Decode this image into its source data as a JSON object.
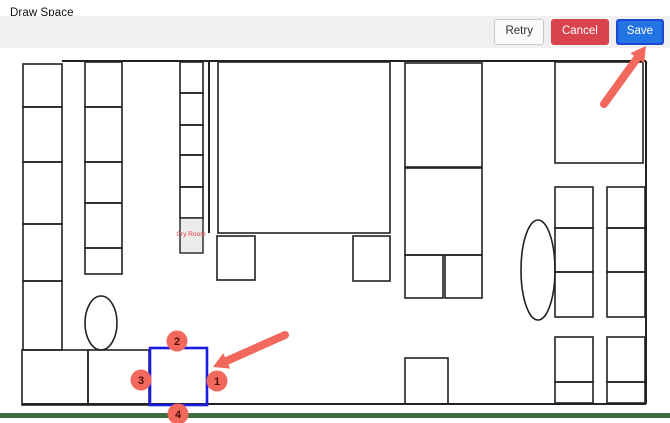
{
  "header": {
    "title": "Draw Space"
  },
  "toolbar": {
    "retry_label": "Retry",
    "cancel_label": "Cancel",
    "save_label": "Save",
    "cancel_color": "#d9434e",
    "save_color": "#2273e3"
  },
  "floorplan": {
    "wall_color": "#222222",
    "annotation_color": "#f2685c",
    "highlight_color": "#1c1ce0",
    "marker_text_color": "#4d120d",
    "green_bar_color": "#3a6e3e",
    "gray_fill": "#ececec",
    "cry_room_label": "Cry Room",
    "cry_room_label_color": "#e23b3b",
    "cry_room_pos": [
      191,
      236
    ],
    "walls": [
      [
        62,
        61,
        646,
        61
      ],
      [
        646,
        61,
        646,
        404
      ],
      [
        22,
        404,
        646,
        404
      ],
      [
        209,
        62,
        209,
        233
      ]
    ],
    "rects": [
      [
        23,
        64,
        39,
        43
      ],
      [
        23,
        107,
        39,
        55
      ],
      [
        23,
        162,
        39,
        62
      ],
      [
        23,
        224,
        39,
        57
      ],
      [
        23,
        281,
        39,
        69
      ],
      [
        22,
        350,
        66,
        55
      ],
      [
        88,
        350,
        61,
        55
      ],
      [
        85,
        62,
        37,
        45
      ],
      [
        85,
        107,
        37,
        55
      ],
      [
        85,
        162,
        37,
        41
      ],
      [
        85,
        203,
        37,
        45
      ],
      [
        85,
        248,
        37,
        26
      ],
      [
        180,
        62,
        23,
        31
      ],
      [
        180,
        93,
        23,
        32
      ],
      [
        180,
        125,
        23,
        30
      ],
      [
        180,
        155,
        23,
        32
      ],
      [
        180,
        187,
        23,
        31
      ],
      [
        218,
        62,
        172,
        171
      ],
      [
        217,
        236,
        38,
        44
      ],
      [
        353,
        236,
        37,
        45
      ],
      [
        405,
        63,
        77,
        104
      ],
      [
        405,
        168,
        77,
        87
      ],
      [
        405,
        255,
        38,
        43
      ],
      [
        445,
        255,
        37,
        43
      ],
      [
        405,
        358,
        43,
        46
      ],
      [
        555,
        62,
        88,
        101
      ],
      [
        555,
        187,
        38,
        41
      ],
      [
        555,
        228,
        38,
        44
      ],
      [
        555,
        272,
        38,
        45
      ],
      [
        607,
        187,
        38,
        41
      ],
      [
        607,
        228,
        38,
        44
      ],
      [
        607,
        272,
        38,
        45
      ],
      [
        555,
        337,
        38,
        45
      ],
      [
        555,
        382,
        38,
        21
      ],
      [
        607,
        337,
        38,
        45
      ],
      [
        607,
        382,
        38,
        21
      ]
    ],
    "gray_rects": [
      [
        180,
        218,
        23,
        35
      ]
    ],
    "ellipses": [
      [
        101,
        323,
        16,
        27
      ],
      [
        538,
        270,
        17,
        50
      ]
    ],
    "highlight_rect": [
      150,
      348,
      57,
      57
    ],
    "markers": [
      {
        "label": "1",
        "x": 217,
        "y": 381
      },
      {
        "label": "2",
        "x": 177,
        "y": 341
      },
      {
        "label": "3",
        "x": 141,
        "y": 380
      },
      {
        "label": "4",
        "x": 178,
        "y": 414
      }
    ],
    "arrows": [
      {
        "x1": 285,
        "y1": 335,
        "x2": 213,
        "y2": 367
      },
      {
        "x1": 604,
        "y1": 104,
        "x2": 646,
        "y2": 46
      }
    ],
    "green_bar": [
      0,
      413,
      670,
      5
    ]
  }
}
